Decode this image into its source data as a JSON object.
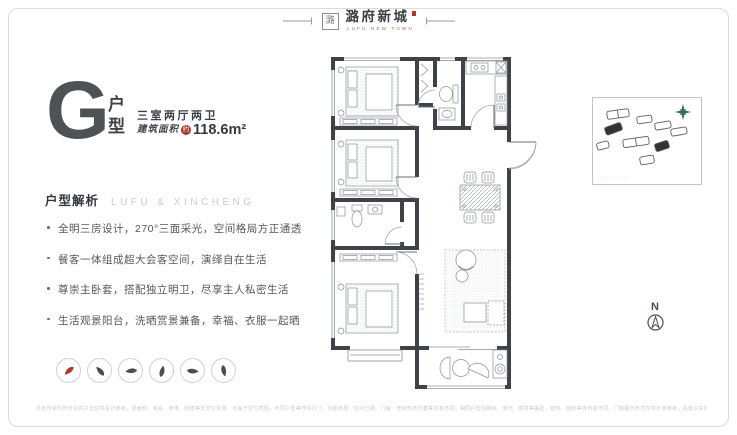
{
  "logo": {
    "seal": "潞",
    "name": "潞府新城",
    "name_en": "LUFU NEW TOWN"
  },
  "unit": {
    "letter": "G",
    "type_label_1": "户",
    "type_label_2": "型",
    "layout": "三室两厅两卫",
    "area_label": "建筑面积",
    "area_approx": "约",
    "area_value": "118.6m²"
  },
  "analysis": {
    "title": "户型解析",
    "subtitle": "LUFU & XINCHENG",
    "bullets": [
      "全明三房设计，270°三面采光，空间格局方正通透",
      "餐客一体组成超大会客空间，演绎自在生活",
      "尊崇主卧套，搭配独立明卫，尽享主人私密生活",
      "生活观景阳台，洗晒赏景兼备，幸福、衣服一起晒"
    ]
  },
  "feature_icons": [
    {
      "name": "red-brush-stroke-icon",
      "color": "#a93a2e"
    },
    {
      "name": "ink-brush-stroke-icon-1",
      "color": "#4a4e54"
    },
    {
      "name": "ink-brush-stroke-icon-2",
      "color": "#4a4e54"
    },
    {
      "name": "ink-brush-stroke-icon-3",
      "color": "#4a4e54"
    },
    {
      "name": "ink-brush-stroke-icon-4",
      "color": "#4a4e54"
    },
    {
      "name": "ink-brush-stroke-icon-5",
      "color": "#4a4e54"
    }
  ],
  "site_map": {
    "legend": "·······",
    "compass_color": "#34695c"
  },
  "north": {
    "label": "N"
  },
  "disclaimer": {
    "text": "本宣传资料所涉及的户型仅供设计参考，其面积、家具、家电、绿植等非交付标准，不属于交付范围，不同户型等开间尺寸、功能布局、空间分隔、门窗／管材形态位置等均有不同；相同户型因楼栋、单元、楼层等差别，结构、面积等也可能不同，门窗展示形式仅供示意参考，具体以实际交付为准。"
  },
  "colors": {
    "accent_red": "#a93a2e",
    "wall": "#3e434a",
    "compass_teal": "#34695c"
  }
}
